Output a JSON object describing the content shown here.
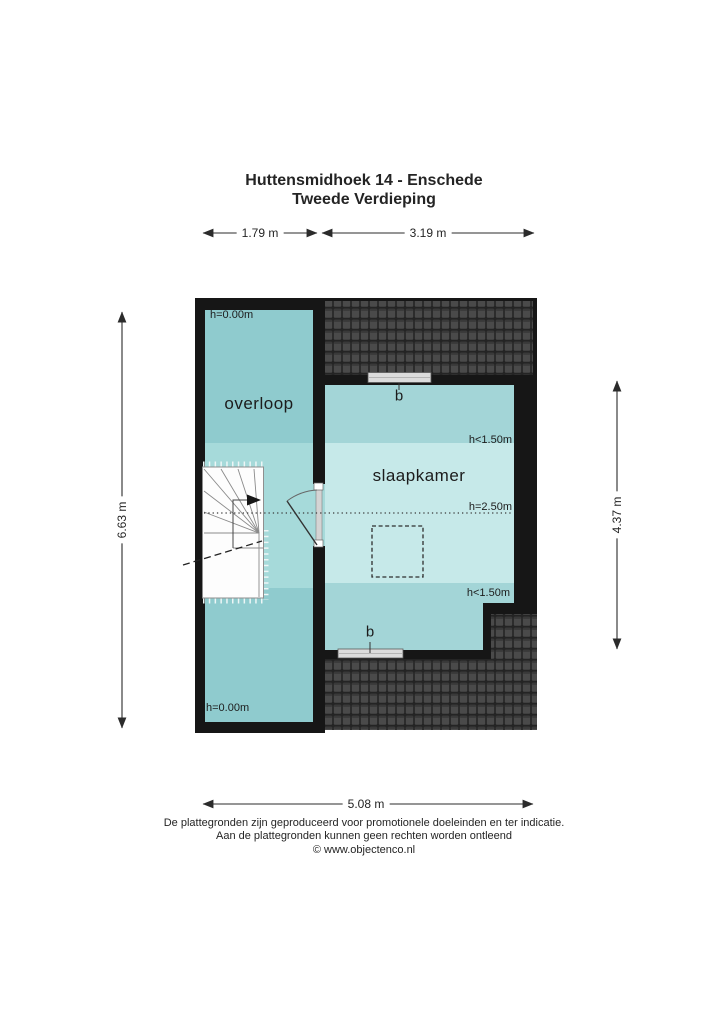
{
  "header": {
    "title_line1": "Huttensmidhoek 14 - Enschede",
    "title_line2": "Tweede Verdieping"
  },
  "dimensions": {
    "top_left": "1.79 m",
    "top_right": "3.19 m",
    "left": "6.63 m",
    "right": "4.37 m",
    "bottom": "5.08 m"
  },
  "rooms": {
    "overloop": {
      "label": "overloop",
      "height_top": "h=0.00m",
      "height_bottom": "h=0.00m"
    },
    "slaapkamer": {
      "label": "slaapkamer",
      "height_band_top": "h<1.50m",
      "height_center": "h=2.50m",
      "height_band_bottom": "h<1.50m",
      "window_top_label": "b",
      "window_bottom_label": "b"
    }
  },
  "footer": {
    "disclaimer_line1": "De plattegronden zijn geproduceerd voor promotionele doeleinden en ter indicatie.",
    "disclaimer_line2": "Aan de plattegronden kunnen geen rechten worden ontleend",
    "credit": "© www.objectenco.nl"
  },
  "colors": {
    "wall": "#161616",
    "overloop_fill_dark": "#8fcbce",
    "overloop_fill_light": "#a6dada",
    "slaapkamer_fill_medium": "#a3d5d7",
    "slaapkamer_fill_light": "#c6e9e9",
    "roof_tile_base": "#242424",
    "roof_tile_face": "#4a4a4a",
    "window_fill": "#dcdcdc"
  }
}
